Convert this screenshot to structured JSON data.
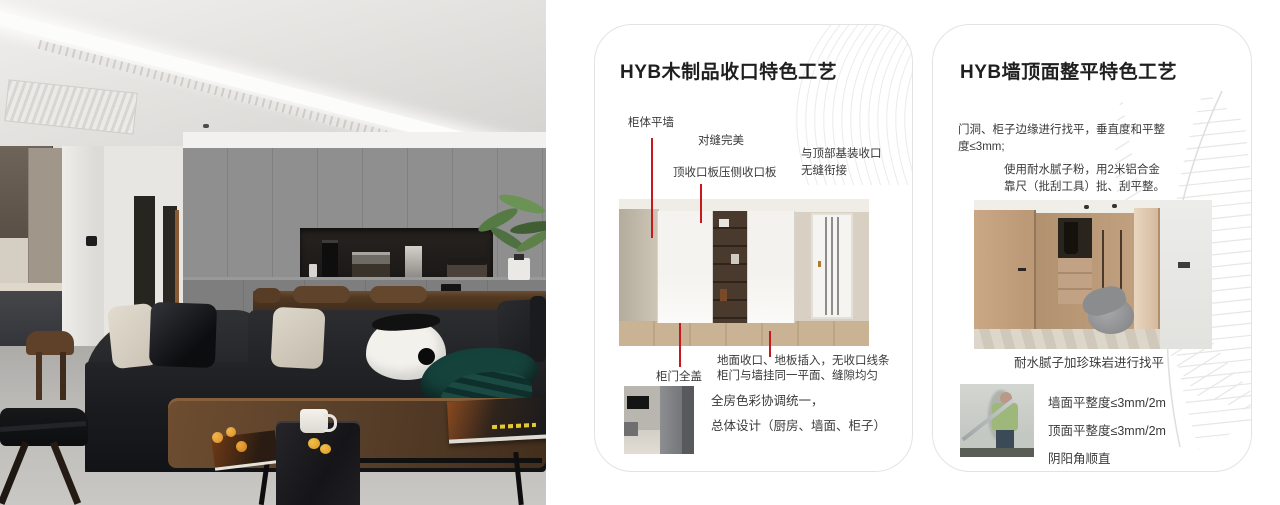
{
  "accent": {
    "red": "#c7191d"
  },
  "card1": {
    "title": "HYB木制品收口特色工艺",
    "label_cabinet_flush": "柜体平墙",
    "label_seam_perfect": "对缝完美",
    "label_top_board": "顶收口板压侧收口板",
    "label_top_joint_1": "与顶部基装收口",
    "label_top_joint_2": "无缝衔接",
    "label_door_cover": "柜门全盖",
    "label_floor_1": "地面收口、地板插入，无收口线条",
    "label_floor_2": "柜门与墙挂同一平面、缝隙均匀",
    "summary_1": "全房色彩协调统一，",
    "summary_2": "总体设计（厨房、墙面、柜子）"
  },
  "card2": {
    "title": "HYB墙顶面整平特色工艺",
    "para1_1": "门洞、柜子边缘进行找平，垂直度和平整",
    "para1_2": "度≤3mm;",
    "para2_1": "使用耐水腻子粉，用2米铝合金",
    "para2_2": "靠尺（批刮工具）批、刮平整。",
    "caption": "耐水腻子加珍珠岩进行找平",
    "spec_1": "墙面平整度≤3mm/2m",
    "spec_2": "顶面平整度≤3mm/2m",
    "spec_3": "阴阳角顺直"
  }
}
